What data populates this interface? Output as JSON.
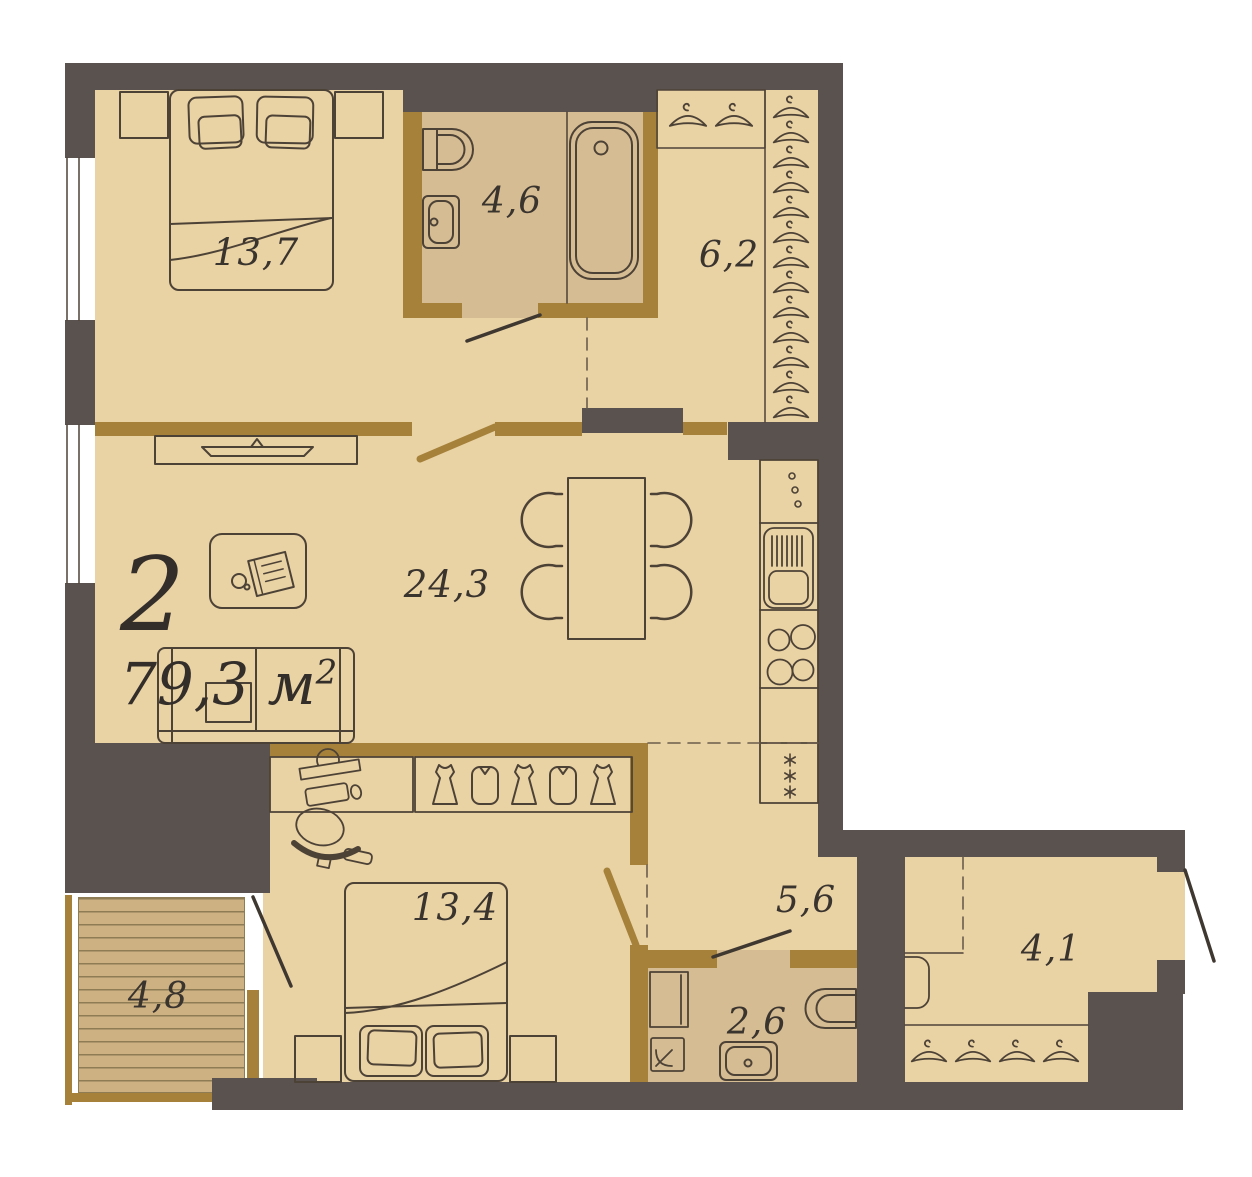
{
  "plan": {
    "apartment": {
      "number": "2",
      "area_value": "79,3",
      "area_unit": " м",
      "area_exponent": "2"
    },
    "rooms": {
      "bedroom_top": {
        "name": "bedroom",
        "label": "13,7"
      },
      "bathroom_top": {
        "name": "bathroom",
        "label": "4,6"
      },
      "wardrobe_hall": {
        "name": "wardrobe-hall",
        "label": "6,2"
      },
      "living_kitchen": {
        "name": "living-kitchen",
        "label": "24,3"
      },
      "bedroom_bottom": {
        "name": "bedroom",
        "label": "13,4"
      },
      "hallway": {
        "name": "hallway",
        "label": "5,6"
      },
      "bathroom_bottom": {
        "name": "bathroom",
        "label": "2,6"
      },
      "balcony": {
        "name": "balcony",
        "label": "4,8"
      },
      "entry": {
        "name": "entry-hall",
        "label": "4,1"
      }
    },
    "colors": {
      "wall_dark": "#5a524e",
      "wall_gold": "#a5813a",
      "floor": "#e9d2a4",
      "floor_wet": "#d6bc93",
      "balcony_deck": "#cdb183",
      "outline": "#4d4236",
      "text": "#3a342e",
      "background": "#ffffff"
    },
    "icons": [
      "double-bed-icon",
      "pillow-icon",
      "nightstand-icon",
      "toilet-icon",
      "washbasin-icon",
      "bathtub-icon",
      "hanger-icon",
      "shelf-icon",
      "tv-icon",
      "tv-console-icon",
      "coffee-table-icon",
      "magazine-icon",
      "cup-icon",
      "sofa-icon",
      "dining-table-icon",
      "chair-icon",
      "kitchen-cabinet-icon",
      "drawer-handles-icon",
      "kitchen-sink-icon",
      "cooktop-icon",
      "fridge-snowflake-icon",
      "desk-icon",
      "office-chair-icon",
      "wardrobe-icon",
      "dress-icon",
      "jacket-icon",
      "washing-machine-icon",
      "cabinet-icon",
      "window-icon",
      "door-leaf-icon",
      "balcony-deck-icon"
    ]
  }
}
